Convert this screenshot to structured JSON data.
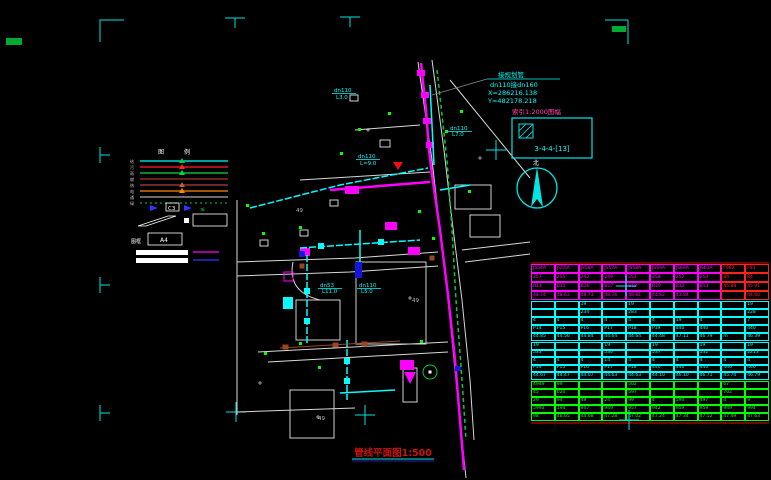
{
  "colors": {
    "bg": "#000000",
    "frame": "#00e5e5",
    "pipe_magenta": "#ff00ff",
    "pipe_cyan": "#00ffff",
    "veg_green": "#00ff00",
    "road_white": "#d8d8d8",
    "table_red": "#ff2020",
    "title_red": "#cc1111",
    "brown": "#994422"
  },
  "title": {
    "text": "管线平面图1:500"
  },
  "annotations": {
    "connection": {
      "line1": "接规划管",
      "line2": "dn110接dn160",
      "line3": "X=286216.138",
      "line4": "Y=482178.218"
    },
    "index_label": "索引1:2000图幅",
    "index_code": "3-4-4-[13]",
    "north_label": "北"
  },
  "legend": {
    "header_left": "图",
    "header_right": "例",
    "items": [
      {
        "label": "给",
        "color": "#00ffff",
        "style": "solid",
        "marker": "#00cc44"
      },
      {
        "label": "污",
        "color": "#ff2222",
        "style": "solid",
        "marker": "#ff2222"
      },
      {
        "label": "雨",
        "color": "#00dd44",
        "style": "solid",
        "marker": "#00dd44"
      },
      {
        "label": "燃",
        "color": "#993333",
        "style": "solid",
        "marker": ""
      },
      {
        "label": "热",
        "color": "#aa4444",
        "style": "solid",
        "marker": "#cc5533"
      },
      {
        "label": "电",
        "color": "#ff8800",
        "style": "solid",
        "marker": "#ff8800"
      },
      {
        "label": "通",
        "color": "#aaaaaa",
        "style": "solid",
        "marker": ""
      },
      {
        "label": "绿",
        "color": "#00aa33",
        "style": "dotted",
        "marker": ""
      }
    ],
    "arrow_box_label": "C3",
    "leq_symbol": "≤",
    "a4_label": "A4",
    "a4_caption": "图框"
  },
  "map": {
    "labels": [
      {
        "t": "dn110",
        "x": 334,
        "y": 92,
        "c": "#00ffff",
        "u": 1
      },
      {
        "t": "L3.0",
        "x": 336,
        "y": 99,
        "c": "#00ffff",
        "u": 0
      },
      {
        "t": "dn110",
        "x": 358,
        "y": 158,
        "c": "#00ffff",
        "u": 1
      },
      {
        "t": "L=9.0",
        "x": 360,
        "y": 165,
        "c": "#00ffff",
        "u": 0
      },
      {
        "t": "dn53",
        "x": 320,
        "y": 287,
        "c": "#00ffff",
        "u": 1
      },
      {
        "t": "L11.0",
        "x": 322,
        "y": 293,
        "c": "#00ffff",
        "u": 0
      },
      {
        "t": "dn110",
        "x": 359,
        "y": 287,
        "c": "#00ffff",
        "u": 1
      },
      {
        "t": "L5.0",
        "x": 361,
        "y": 293,
        "c": "#00ffff",
        "u": 0
      },
      {
        "t": "dn110",
        "x": 450,
        "y": 130,
        "c": "#00ffff",
        "u": 1
      },
      {
        "t": "L7.0",
        "x": 452,
        "y": 136,
        "c": "#00ffff",
        "u": 0
      },
      {
        "t": "49",
        "x": 318,
        "y": 420,
        "c": "#bbbbbb",
        "u": 0
      },
      {
        "t": "49",
        "x": 296,
        "y": 212,
        "c": "#bbbbbb",
        "u": 0
      },
      {
        "t": "49",
        "x": 412,
        "y": 302,
        "c": "#bbbbbb",
        "u": 0
      }
    ]
  },
  "table": {
    "sections": [
      {
        "name": "magenta-section",
        "color": "#ff00ff",
        "height": 36,
        "red_cols": [
          8,
          9
        ],
        "rows": [
          [
            "JS54A",
            "JS55A",
            "JS56A",
            "JS57A",
            "JS58A",
            "JS59A",
            "JS60A",
            "JS61A",
            "F982",
            "F91"
          ],
          [
            "257",
            "255",
            "242",
            "249",
            "251",
            "258",
            "252",
            "254",
            "84",
            "84"
          ],
          [
            "B14",
            "B15",
            "B16",
            "B17",
            "B18",
            "B19",
            "B12",
            "B13",
            "45.88",
            "45.91"
          ],
          [
            "48.74",
            "48.63",
            "48.73",
            "48.76",
            "48.81",
            "44.82",
            "43.84",
            "",
            "",
            "44.60"
          ]
        ]
      },
      {
        "name": "cyan-section-1",
        "color": "#00ffff",
        "height": 40,
        "red_cols": [],
        "rows": [
          [
            "",
            "",
            "19",
            "",
            "19",
            "",
            "",
            "",
            "",
            "19"
          ],
          [
            "",
            "",
            "234",
            "",
            "283",
            "",
            "",
            "",
            "",
            "228"
          ],
          [
            "4",
            "4",
            "4",
            "4",
            "4",
            "4",
            "19",
            "4",
            "",
            "7"
          ],
          [
            "P14",
            "P15",
            "P16",
            "P17",
            "P18",
            "P19",
            "440",
            "440",
            "",
            "440"
          ],
          [
            "44.85",
            "44.56",
            "44.84",
            "44.64",
            "44.64",
            "44.48",
            "47.11",
            "46.79",
            "m",
            "46.39"
          ]
        ]
      },
      {
        "name": "cyan-section-2",
        "color": "#00ffff",
        "height": 38,
        "red_cols": [],
        "rows": [
          [
            "19",
            "",
            "",
            "19",
            "",
            "19",
            "",
            "19",
            "",
            "19"
          ],
          [
            "533",
            "",
            "",
            "530",
            "",
            "537",
            "",
            "532",
            "",
            "2213"
          ],
          [
            "4",
            "4",
            "4",
            "14",
            "4",
            "4",
            "4",
            "4",
            "4",
            "4"
          ],
          [
            "P14",
            "P15",
            "P16",
            "P17",
            "P18",
            "440",
            "440",
            "440",
            "440",
            "440"
          ],
          [
            "44.67",
            "44.47",
            "44.07",
            "44.63",
            "44.63",
            "44.10",
            "46.10",
            "46.71",
            "45.74",
            "46.79"
          ]
        ]
      },
      {
        "name": "green-section",
        "color": "#00ff00",
        "height": 40,
        "red_cols": [],
        "rows": [
          [
            "4949",
            "99",
            "",
            "",
            "502",
            "",
            "",
            "",
            "67",
            ""
          ],
          [
            "45",
            "020",
            "",
            "",
            "597",
            "",
            "",
            "",
            "702",
            ""
          ],
          [
            "29",
            "94",
            "49",
            "24",
            "99",
            "4",
            "590",
            "497",
            "4",
            "9"
          ],
          [
            "5993",
            "194",
            "947",
            "949",
            "957",
            "942",
            "959",
            "959",
            "949",
            "994"
          ],
          [
            "98",
            "48.65",
            "44.68",
            "47.28",
            "47.02",
            "47.24",
            "47.34",
            "47.52",
            "47.49",
            "47.63"
          ]
        ]
      }
    ]
  }
}
